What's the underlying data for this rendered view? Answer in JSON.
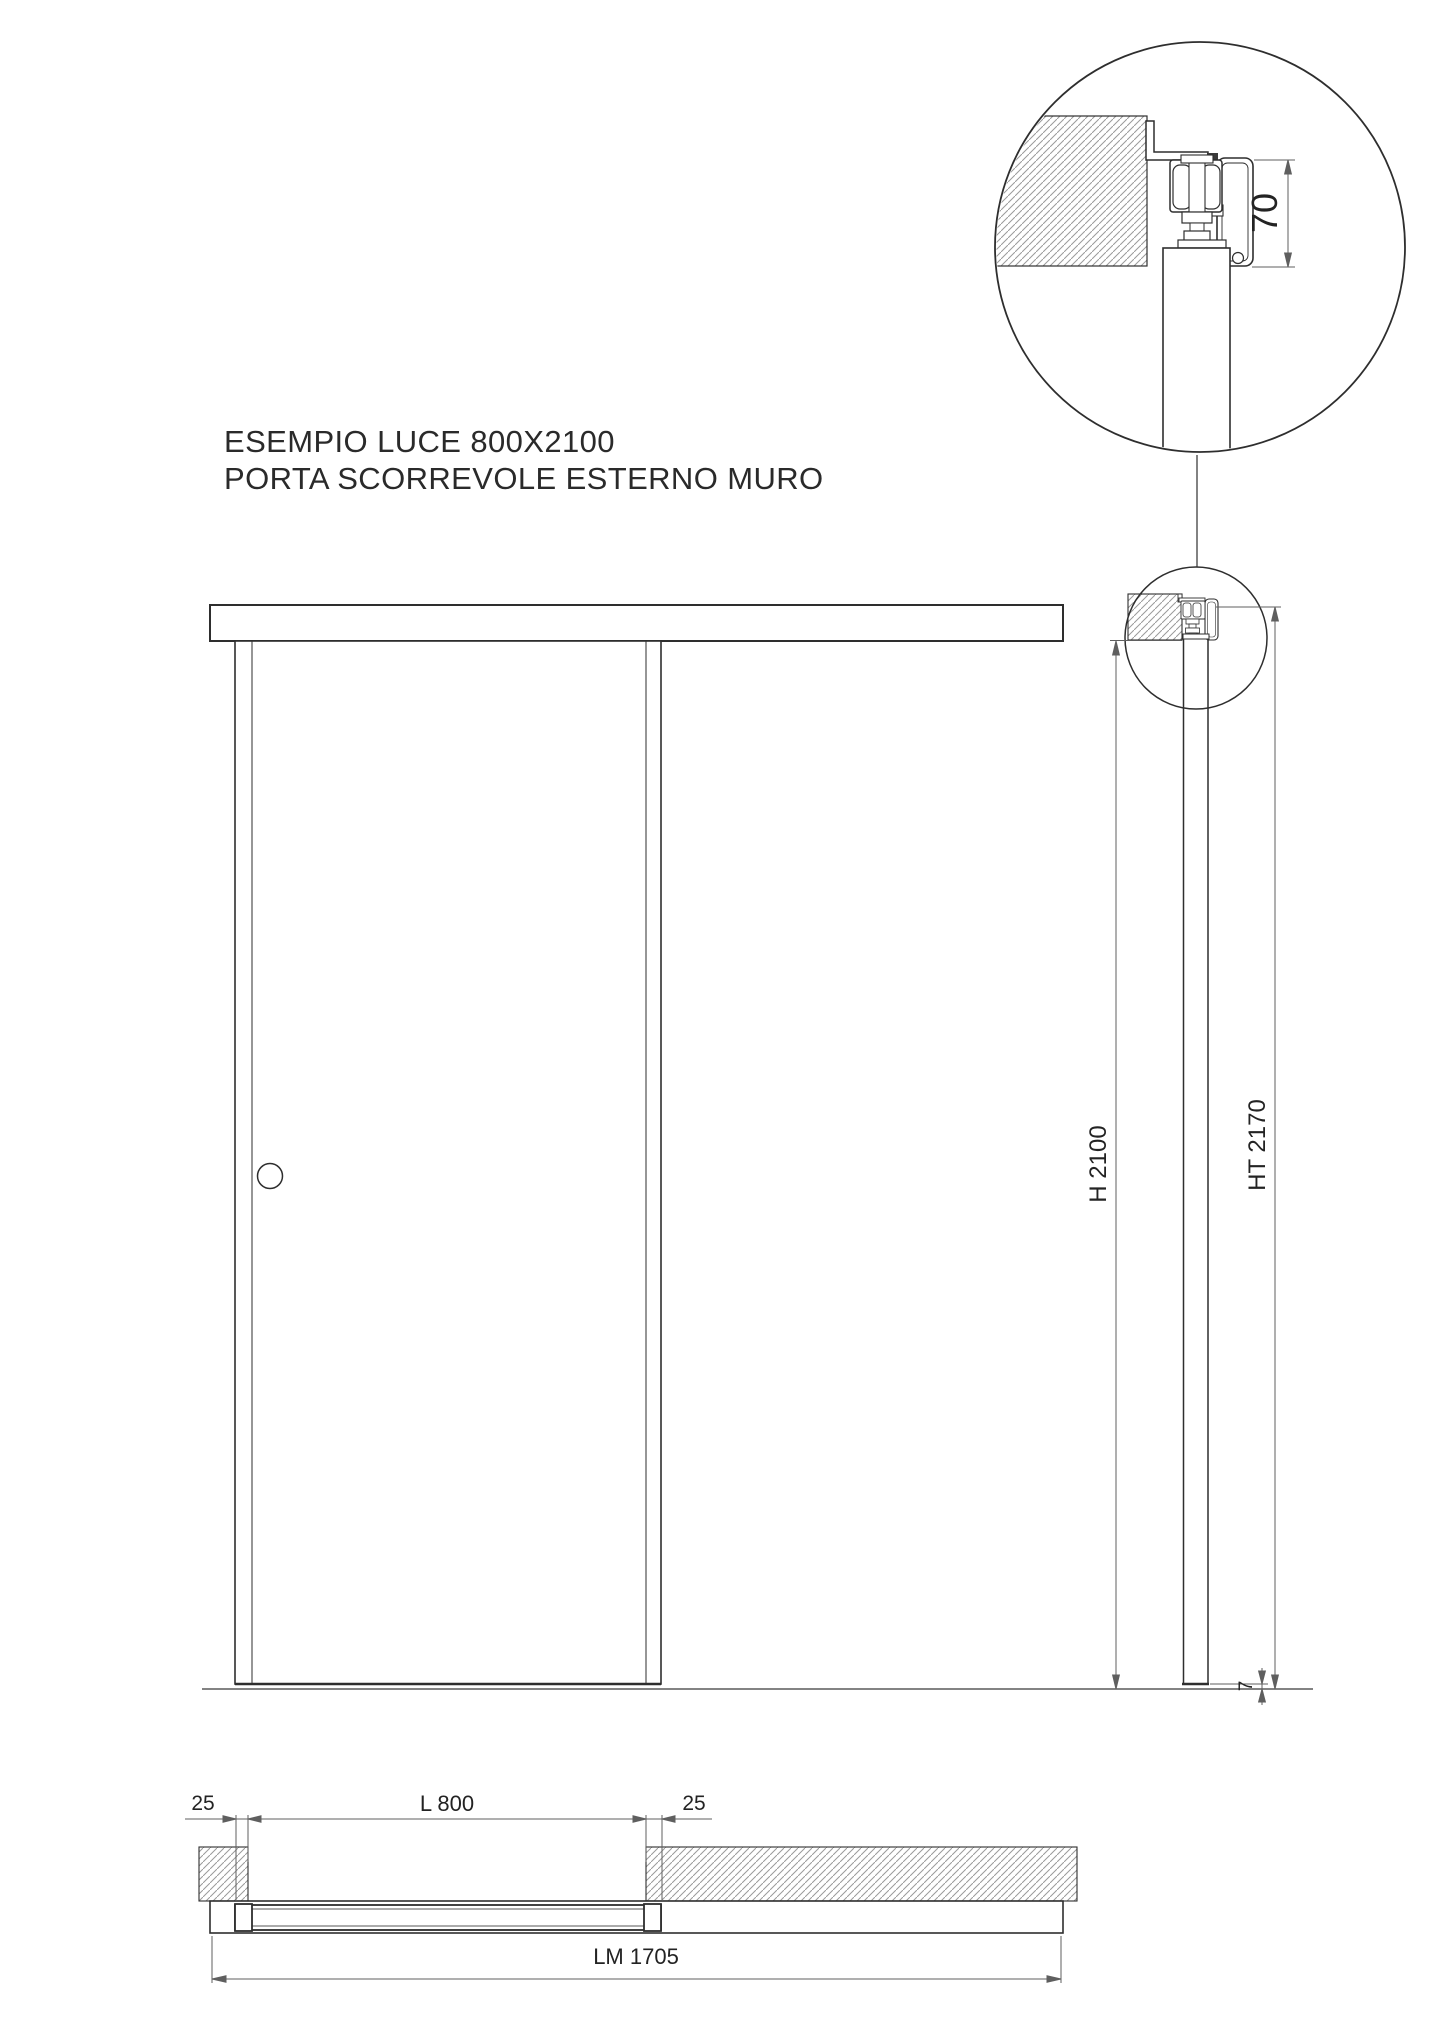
{
  "page": {
    "background": "#ffffff",
    "ink_color": "#2e2e2e",
    "dim_color": "#5f5f5f",
    "hatch_color": "#9a9a9a"
  },
  "title": {
    "line1": "ESEMPIO LUCE 800X2100",
    "line2": "PORTA SCORREVOLE ESTERNO MURO"
  },
  "detail_callout": {
    "track_height_dim": "70"
  },
  "section_view": {
    "opening_height_dim": "H 2100",
    "total_height_dim": "HT 2170",
    "floor_gap_dim": "7"
  },
  "plan_view": {
    "overlap_left_dim": "25",
    "opening_width_dim": "L 800",
    "overlap_right_dim": "25",
    "track_length_dim": "LM 1705"
  }
}
